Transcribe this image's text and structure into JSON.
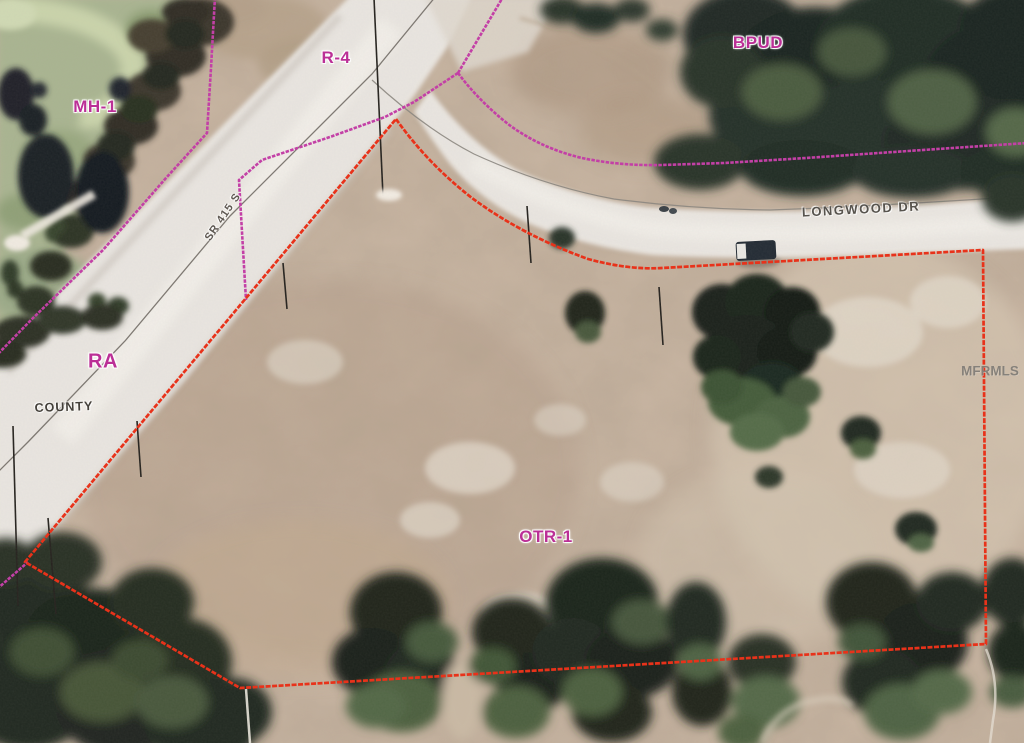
{
  "map": {
    "zoning_labels": {
      "mh1": "MH-1",
      "r4": "R-4",
      "bpud": "BPUD",
      "ra": "RA",
      "otr1": "OTR-1"
    },
    "road_labels": {
      "sr415": "SR 415 S",
      "county": "COUNTY",
      "longwood": "LONGWOOD DR"
    },
    "watermark": "MFRMLS",
    "colors": {
      "parcel_boundary": "#e8321a",
      "zoning_boundary": "#c340a6",
      "zoning_label": "#bb2f96",
      "road_label": "#57534d",
      "watermark_text": "#807c76"
    }
  }
}
